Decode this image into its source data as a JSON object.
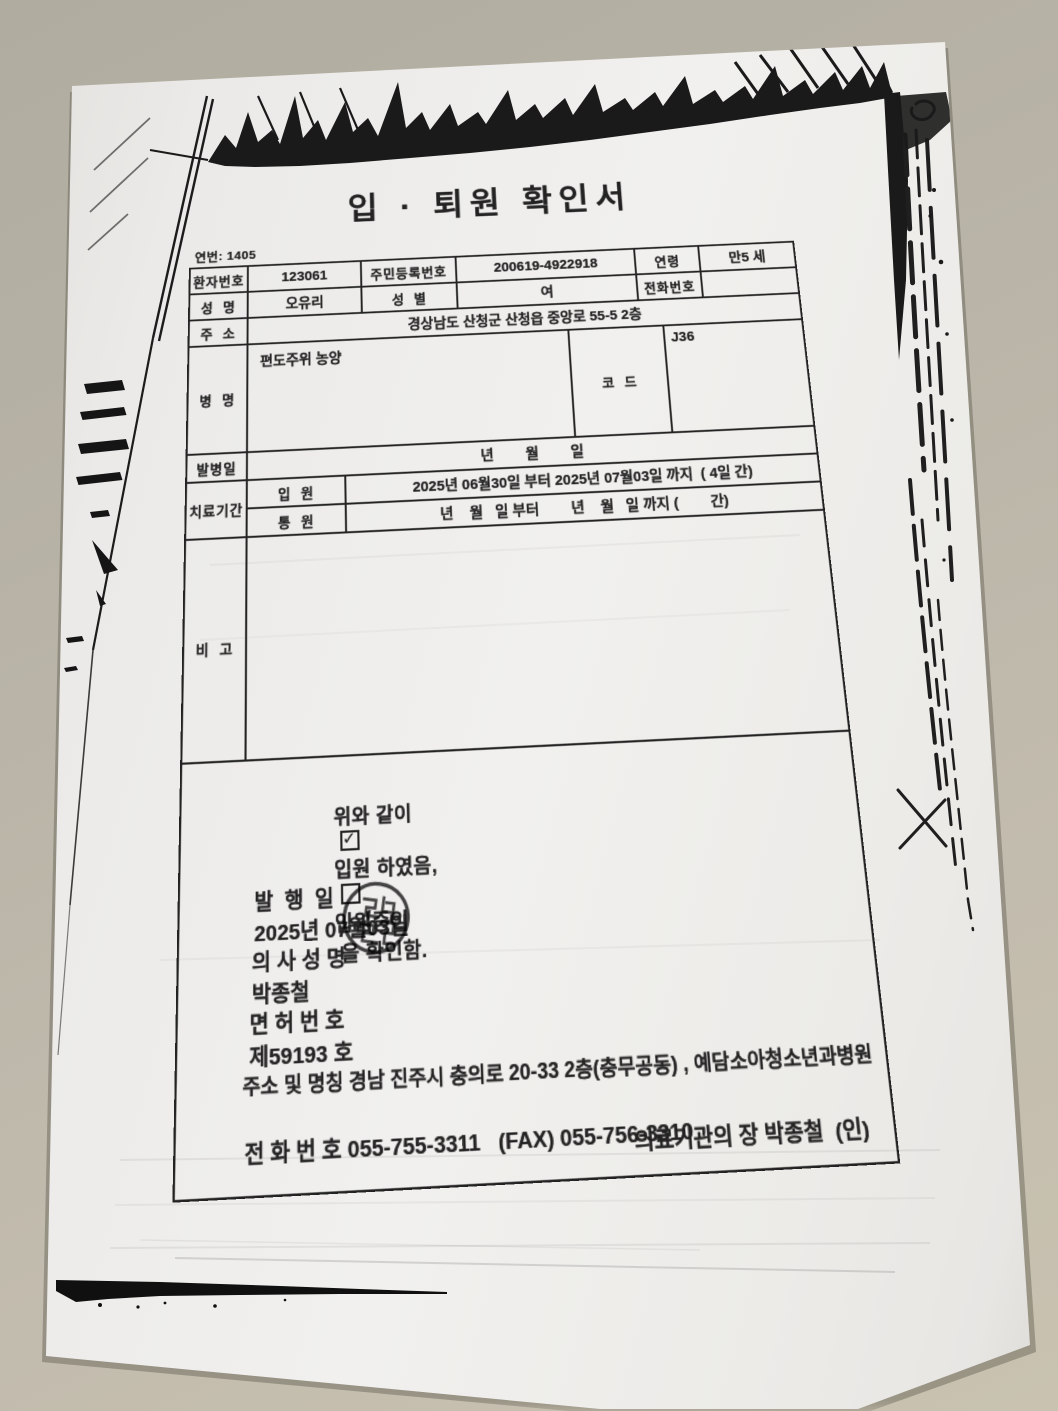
{
  "colors": {
    "desk": "#b6b1a4",
    "paper": "#edecea",
    "ink": "#232323"
  },
  "document": {
    "serial": "연번: 1405",
    "title": "입 · 퇴원 확인서",
    "table": {
      "patient_no_label": "환자번호",
      "patient_no": "123061",
      "resident_no_label": "주민등록번호",
      "resident_no": "200619-4922918",
      "age_label": "연령",
      "age": "만5 세",
      "name_label": "성  명",
      "name": "오유리",
      "sex_label": "성  별",
      "sex": "여",
      "phone_label": "전화번호",
      "phone": "",
      "address_label": "주  소",
      "address": "경상남도 산청군 산청읍 중앙로 55-5 2층",
      "disease_label": "병  명",
      "disease": "편도주위 농양",
      "code_label": "코  드",
      "code": "J36",
      "onset_label": "발병일",
      "onset": "년        월        일",
      "period_label": "치료기간",
      "inpatient_label": "입  원",
      "inpatient": "2025년 06월30일 부터 2025년 07월03일 까지  ( 4일 간)",
      "outpatient_label": "통  원",
      "outpatient": "년    월   일 부터        년    월   일 까지 (        간)",
      "note_label": "비  고",
      "note": ""
    },
    "confirmation": {
      "lead": "위와 같이",
      "check_glyph": "✓",
      "opt1": "입원 하였음,",
      "opt2": "입원중임",
      "tail": " 을 확인함."
    },
    "footer": {
      "issue_label": "발  행  일",
      "issue_value": "2025년 07월03일",
      "doctor_label": "의 사 성 명",
      "doctor_value": "박종철",
      "license_label": "면 허 번 호",
      "license_value": "제59193 호",
      "org_label": "주소 및 명칭",
      "org_value": "경남 진주시 충의로 20-33 2층(충무공동) , 예담소아청소년과병원",
      "tel_label": "전 화 번 호",
      "tel_value": "055-755-3311   (FAX) 055-756-3310",
      "director": "의료기관의 장 박종철  (인)"
    }
  }
}
